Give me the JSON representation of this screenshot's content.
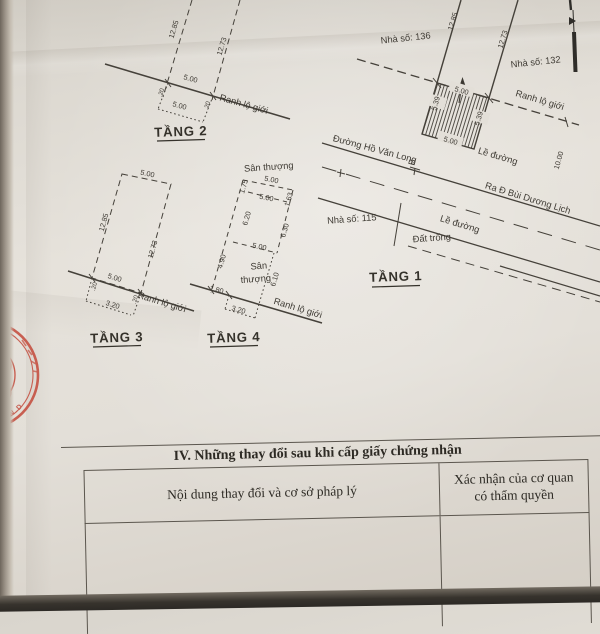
{
  "plans": {
    "tang1": {
      "label": "TẦNG 1",
      "house_left": "Nhà số: 136",
      "house_right": "Nhà số: 132",
      "house_lower": "Nhà số: 115",
      "street_name": "Đường Hồ Văn Long",
      "street_marker": "B",
      "street_direction": "Ra Đ Bùi Dương Lịch",
      "sidewalk_upper": "Lề đường",
      "sidewalk_lower": "Lề đường",
      "vacant_lot": "Đất trống",
      "boundary": "Ranh lộ giới",
      "dim_side_left_len": "12.85",
      "dim_side_right_len": "12.73",
      "dim_top": "5.00",
      "dim_left": "5.39",
      "dim_right": "5.39",
      "dim_bottom": "5.00",
      "dim_road": "10.00"
    },
    "tang2": {
      "label": "TẦNG 2",
      "boundary": "Ranh lộ giới",
      "dim_side_left_len": "12.85",
      "dim_side_right_len": "12.73",
      "dim_width": "5.00",
      "dim_width_lower": "5.00",
      "notch_left": ".20",
      "notch_right": ".20"
    },
    "tang3": {
      "label": "TẦNG 3",
      "boundary": "Ranh lộ giới",
      "dim_top": "5.00",
      "dim_side_left_len": "12.85",
      "dim_side_right_len": "12.73",
      "dim_bottom": "5.00",
      "dim_sliver": "3.20",
      "notch_left": ".20",
      "notch_right": ".20"
    },
    "tang4": {
      "label": "TẦNG 4",
      "boundary": "Ranh lộ giới",
      "terrace_top": "Sân thượng",
      "terrace_mid_1": "Sân",
      "terrace_mid_2": "thượng",
      "dim_top": "5.00",
      "dim_inner": "5.00",
      "dim_mid": "5.00",
      "dim_tl": "1.75",
      "dim_tr": "1.63",
      "dim_left_upper": "6.20",
      "dim_right_upper": "6.30",
      "dim_left_lower": "4.90",
      "dim_right_lower": "6.10",
      "dim_bottom_left": "1.80",
      "dim_sliver": "3.20"
    }
  },
  "table": {
    "section_title": "IV. Những thay đổi sau khi cấp giấy chứng nhận",
    "col_content": "Nội dung thay đổi và cơ sở pháp lý",
    "col_authority_1": "Xác nhận của cơ quan",
    "col_authority_2": "có thẩm quyền"
  },
  "stamp": {
    "text": "U.B.N.D"
  }
}
